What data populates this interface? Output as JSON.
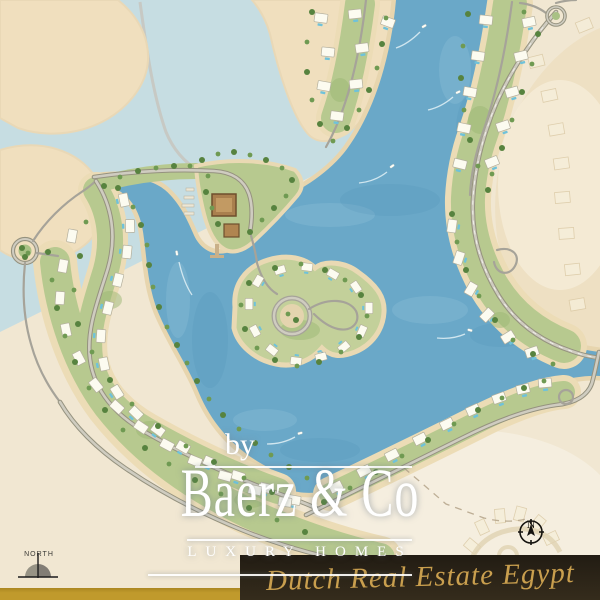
{
  "watermark": {
    "prefix": "by",
    "brand": "Baerz & Co",
    "tagline": "LUXURY HOMES"
  },
  "banner": {
    "text": "Dutch Real Estate Egypt"
  },
  "compass": {
    "label": "N"
  },
  "north_marker": {
    "label": "NORTH"
  },
  "colors": {
    "sand": "#f1e7d2",
    "sand-island": "#f0dfbe",
    "beach-rim": "#e7d5ae",
    "water-deep": "#6aa8c8",
    "water-shallow": "#c6dde2",
    "green-band": "#b7c98f",
    "tree": "#57833f",
    "villa": "#fcfbf0",
    "pool": "#6fc2da",
    "road": "#a6a399",
    "gold-bar": "#c09a2c",
    "banner-bg": "#221c13",
    "banner-text": "#c99f4e",
    "watermark": "#ffffff"
  }
}
